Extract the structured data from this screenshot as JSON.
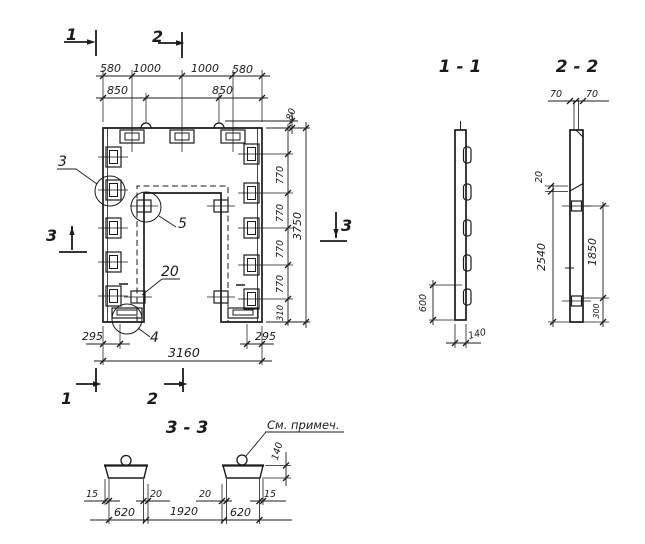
{
  "drawing_type": "structural precast element drawing",
  "colors": {
    "ink": "#1b1b1d",
    "paper": "#ffffff"
  },
  "plan": {
    "markers": {
      "one": "1",
      "two": "2",
      "three": "3"
    },
    "top_row1": [
      "580",
      "1000",
      "1000",
      "580"
    ],
    "top_row2": [
      "850",
      "850"
    ],
    "dim_80": "80",
    "chain_770": "770",
    "dim_310": "310",
    "dim_3750": "3750",
    "dim_295": "295",
    "dim_3160": "3160",
    "callout_3": "3",
    "callout_4": "4",
    "callout_5": "5",
    "callout_20": "20"
  },
  "section_1_1": {
    "title": "1 - 1",
    "dim_600": "600",
    "dim_140": "140"
  },
  "section_2_2": {
    "title": "2 - 2",
    "dim_70": "70",
    "dim_20": "20",
    "dim_2540": "2540",
    "dim_1850": "1850",
    "dim_300": "300"
  },
  "section_3_3": {
    "title": "3 - 3",
    "note": "См. примеч.",
    "dim_140": "140",
    "dim_15": "15",
    "dim_20": "20",
    "dim_620": "620",
    "dim_1920": "1920"
  }
}
